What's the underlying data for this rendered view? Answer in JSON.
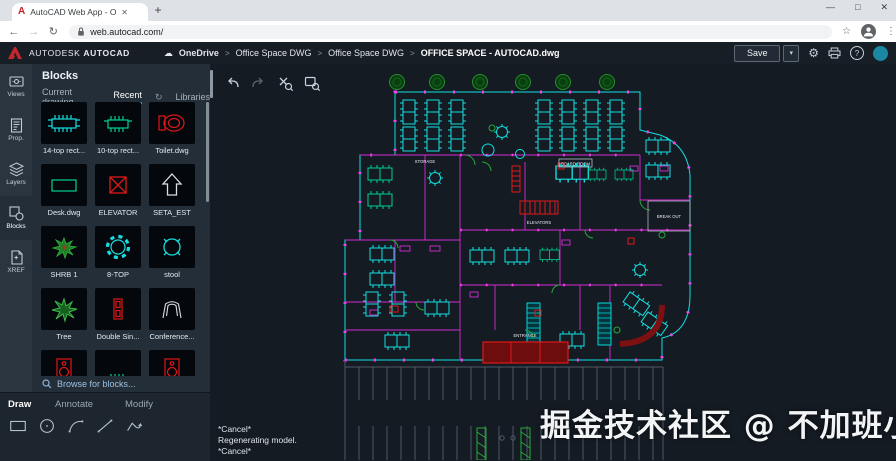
{
  "browser": {
    "tab_title": "AutoCAD Web App - Online CAD",
    "url": "web.autocad.com/"
  },
  "icons": {
    "close": "✕",
    "new_tab": "+",
    "back": "←",
    "forward": "→",
    "reload": "↻",
    "star": "☆",
    "menu": "⋮",
    "minimize": "—",
    "maximize": "□",
    "window_close": "✕",
    "caret_down": "▾",
    "cloud": "☁",
    "gear": "⚙",
    "help": "?",
    "breadcrumb_sep": ">",
    "sync": "↻"
  },
  "header": {
    "brand_primary": "AUTODESK",
    "brand_secondary": "AUTOCAD",
    "breadcrumb": [
      {
        "label": "OneDrive"
      },
      {
        "label": "Office Space DWG"
      },
      {
        "label": "Office Space DWG"
      },
      {
        "label": "OFFICE SPACE - AUTOCAD.dwg"
      }
    ],
    "save_label": "Save"
  },
  "rail": {
    "items": [
      {
        "label": "Views"
      },
      {
        "label": "Prop."
      },
      {
        "label": "Layers"
      },
      {
        "label": "Blocks"
      },
      {
        "label": "XREF"
      }
    ]
  },
  "blocks_panel": {
    "title": "Blocks",
    "tabs": [
      {
        "label": "Current drawing"
      },
      {
        "label": "Recent"
      },
      {
        "label": "Libraries"
      }
    ],
    "blocks": [
      {
        "label": "14-top rect...",
        "icon": "table-14-top"
      },
      {
        "label": "10-top rect...",
        "icon": "table-10-top"
      },
      {
        "label": "Toilet.dwg",
        "icon": "toilet"
      },
      {
        "label": "Desk.dwg",
        "icon": "desk"
      },
      {
        "label": "ELEVATOR",
        "icon": "elevator-box"
      },
      {
        "label": "SETA_EST",
        "icon": "up-arrow"
      },
      {
        "label": "SHRB 1",
        "icon": "shrub"
      },
      {
        "label": "8-TOP",
        "icon": "round-table-8"
      },
      {
        "label": "stool",
        "icon": "stool"
      },
      {
        "label": "Tree",
        "icon": "tree"
      },
      {
        "label": "Double Sin...",
        "icon": "double-sink"
      },
      {
        "label": "Conference...",
        "icon": "conference-chair"
      }
    ],
    "browse_label": "Browse for blocks..."
  },
  "ribbon": {
    "tabs": [
      {
        "label": "Draw"
      },
      {
        "label": "Annotate"
      },
      {
        "label": "Modify"
      }
    ],
    "tools": [
      "rectangle",
      "circle",
      "arc",
      "line",
      "polyline"
    ]
  },
  "canvas": {
    "command_lines": [
      "*Cancel*",
      "Regenerating model.",
      "*Cancel*"
    ],
    "plan_labels": {
      "storage": "STORAGE",
      "board_room": "BOARD ROOM",
      "elevators": "ELEVATORS",
      "break_out": "BREAK OUT",
      "entrance": "ENTRANCE"
    },
    "watermark": "掘金技术社区 @ 不加班小能手"
  },
  "colors": {
    "accent": "#2f8fd0",
    "cad_cyan": "#00e0e0",
    "cad_green_table": "#00cf92",
    "cad_magenta": "#d42bd4",
    "cad_red": "#e01818",
    "tree_green": "#27a838",
    "canvas_bg": "#141b23",
    "avatar_teal": "#1b87a5"
  }
}
